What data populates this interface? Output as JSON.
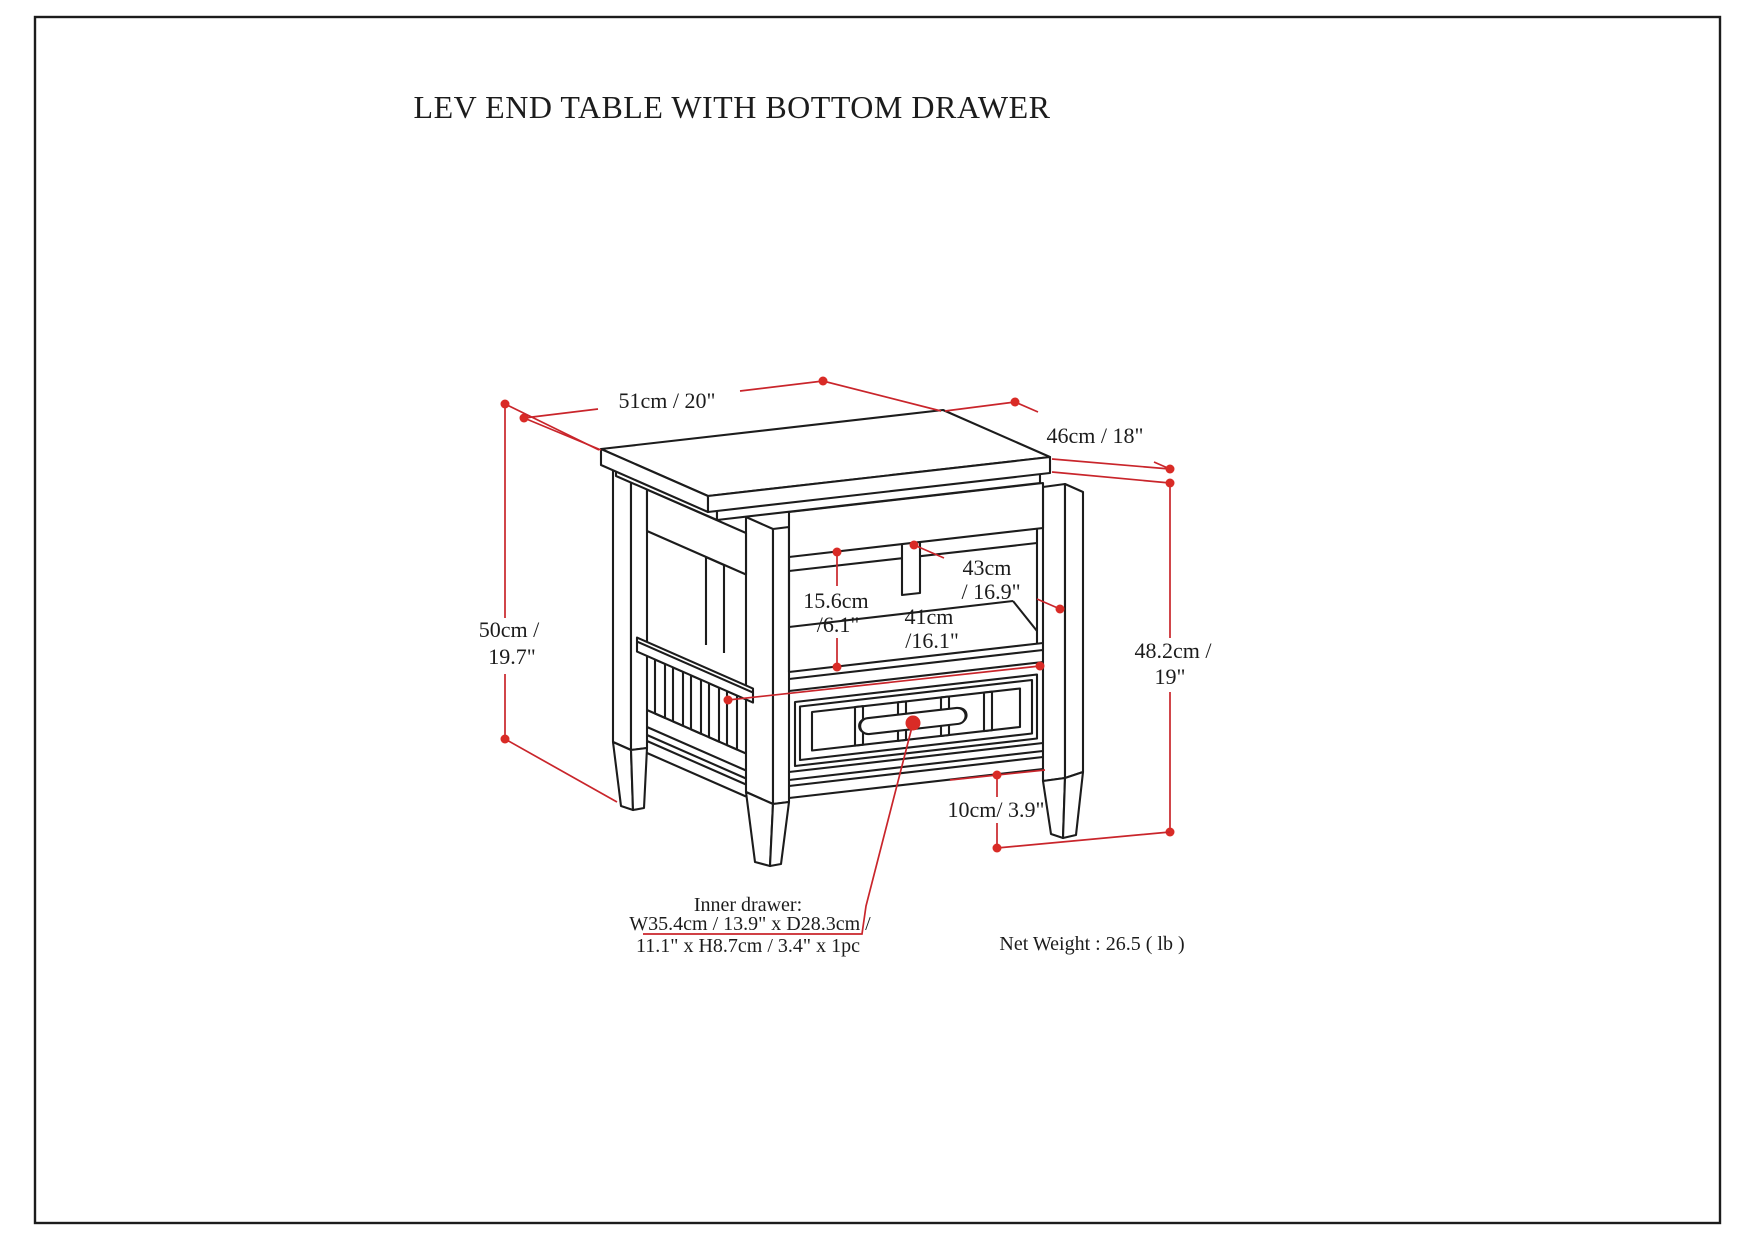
{
  "page": {
    "title": "LEV END TABLE WITH BOTTOM DRAWER"
  },
  "drawing": {
    "labels": {
      "top_width": "51cm / 20\"",
      "top_depth": "46cm / 18\"",
      "overall_height_l1": "50cm /",
      "overall_height_l2": "19.7\"",
      "opening_height_l1": "15.6cm",
      "opening_height_l2": "/6.1\"",
      "opening_width_l1": "41cm",
      "opening_width_l2": "/16.1\"",
      "opening_depth_l1": "43cm",
      "opening_depth_l2": "/ 16.9\"",
      "body_height_l1": "48.2cm /",
      "body_height_l2": "19\"",
      "leg_height": "10cm/ 3.9\""
    },
    "notes": {
      "inner_drawer_l1": "Inner drawer:",
      "inner_drawer_l2": "W35.4cm / 13.9\" x D28.3cm /",
      "inner_drawer_l3": "11.1\" x H8.7cm / 3.4\" x 1pc",
      "net_weight": "Net Weight : 26.5 ( lb )"
    },
    "colors": {
      "dimension_red": "#c9252b",
      "dot_red": "#d92b26",
      "line_black": "#1c1c1c"
    }
  }
}
